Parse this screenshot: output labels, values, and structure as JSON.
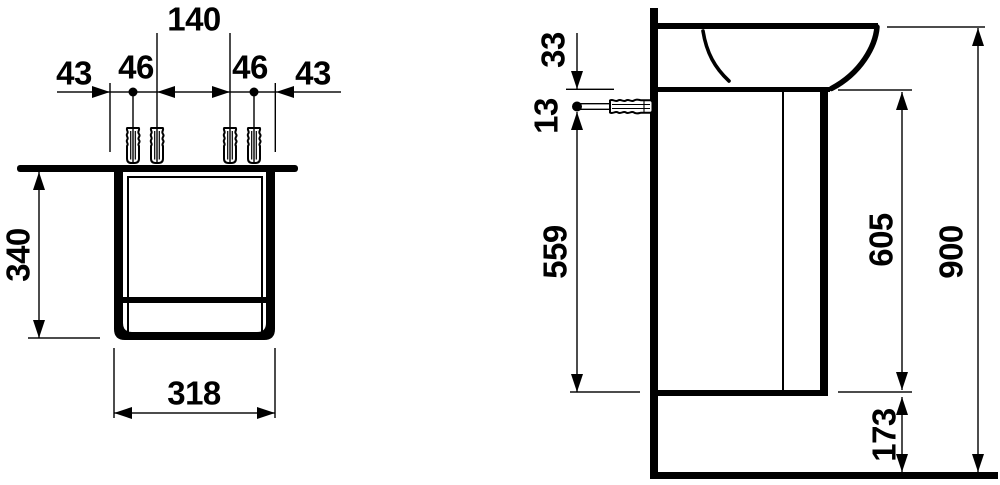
{
  "colors": {
    "line": "#000000",
    "background": "#ffffff"
  },
  "front_view": {
    "dim_labels": {
      "d43_left": "43",
      "d46_left": "46",
      "d140": "140",
      "d46_right": "46",
      "d43_right": "43",
      "d340": "340",
      "d318": "318"
    }
  },
  "side_view": {
    "dim_labels": {
      "d33": "33",
      "d13": "13",
      "d559": "559",
      "d605": "605",
      "d900": "900",
      "d173": "173"
    }
  }
}
